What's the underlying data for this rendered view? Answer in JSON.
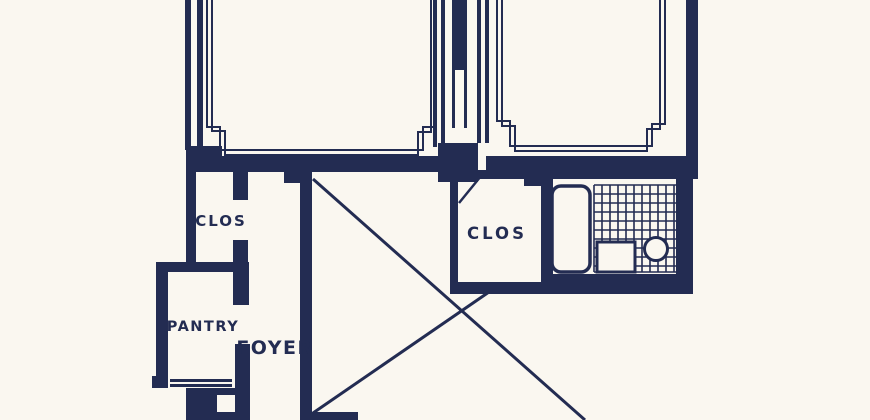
{
  "colors": {
    "paper": "#faf7f0",
    "ink": "#232c52"
  },
  "rooms": {
    "closet_left": {
      "label": "CLOS"
    },
    "pantry": {
      "label": "PANTRY"
    },
    "foyer": {
      "label": "FOYER"
    },
    "closet_right": {
      "label": "CLOS"
    }
  }
}
